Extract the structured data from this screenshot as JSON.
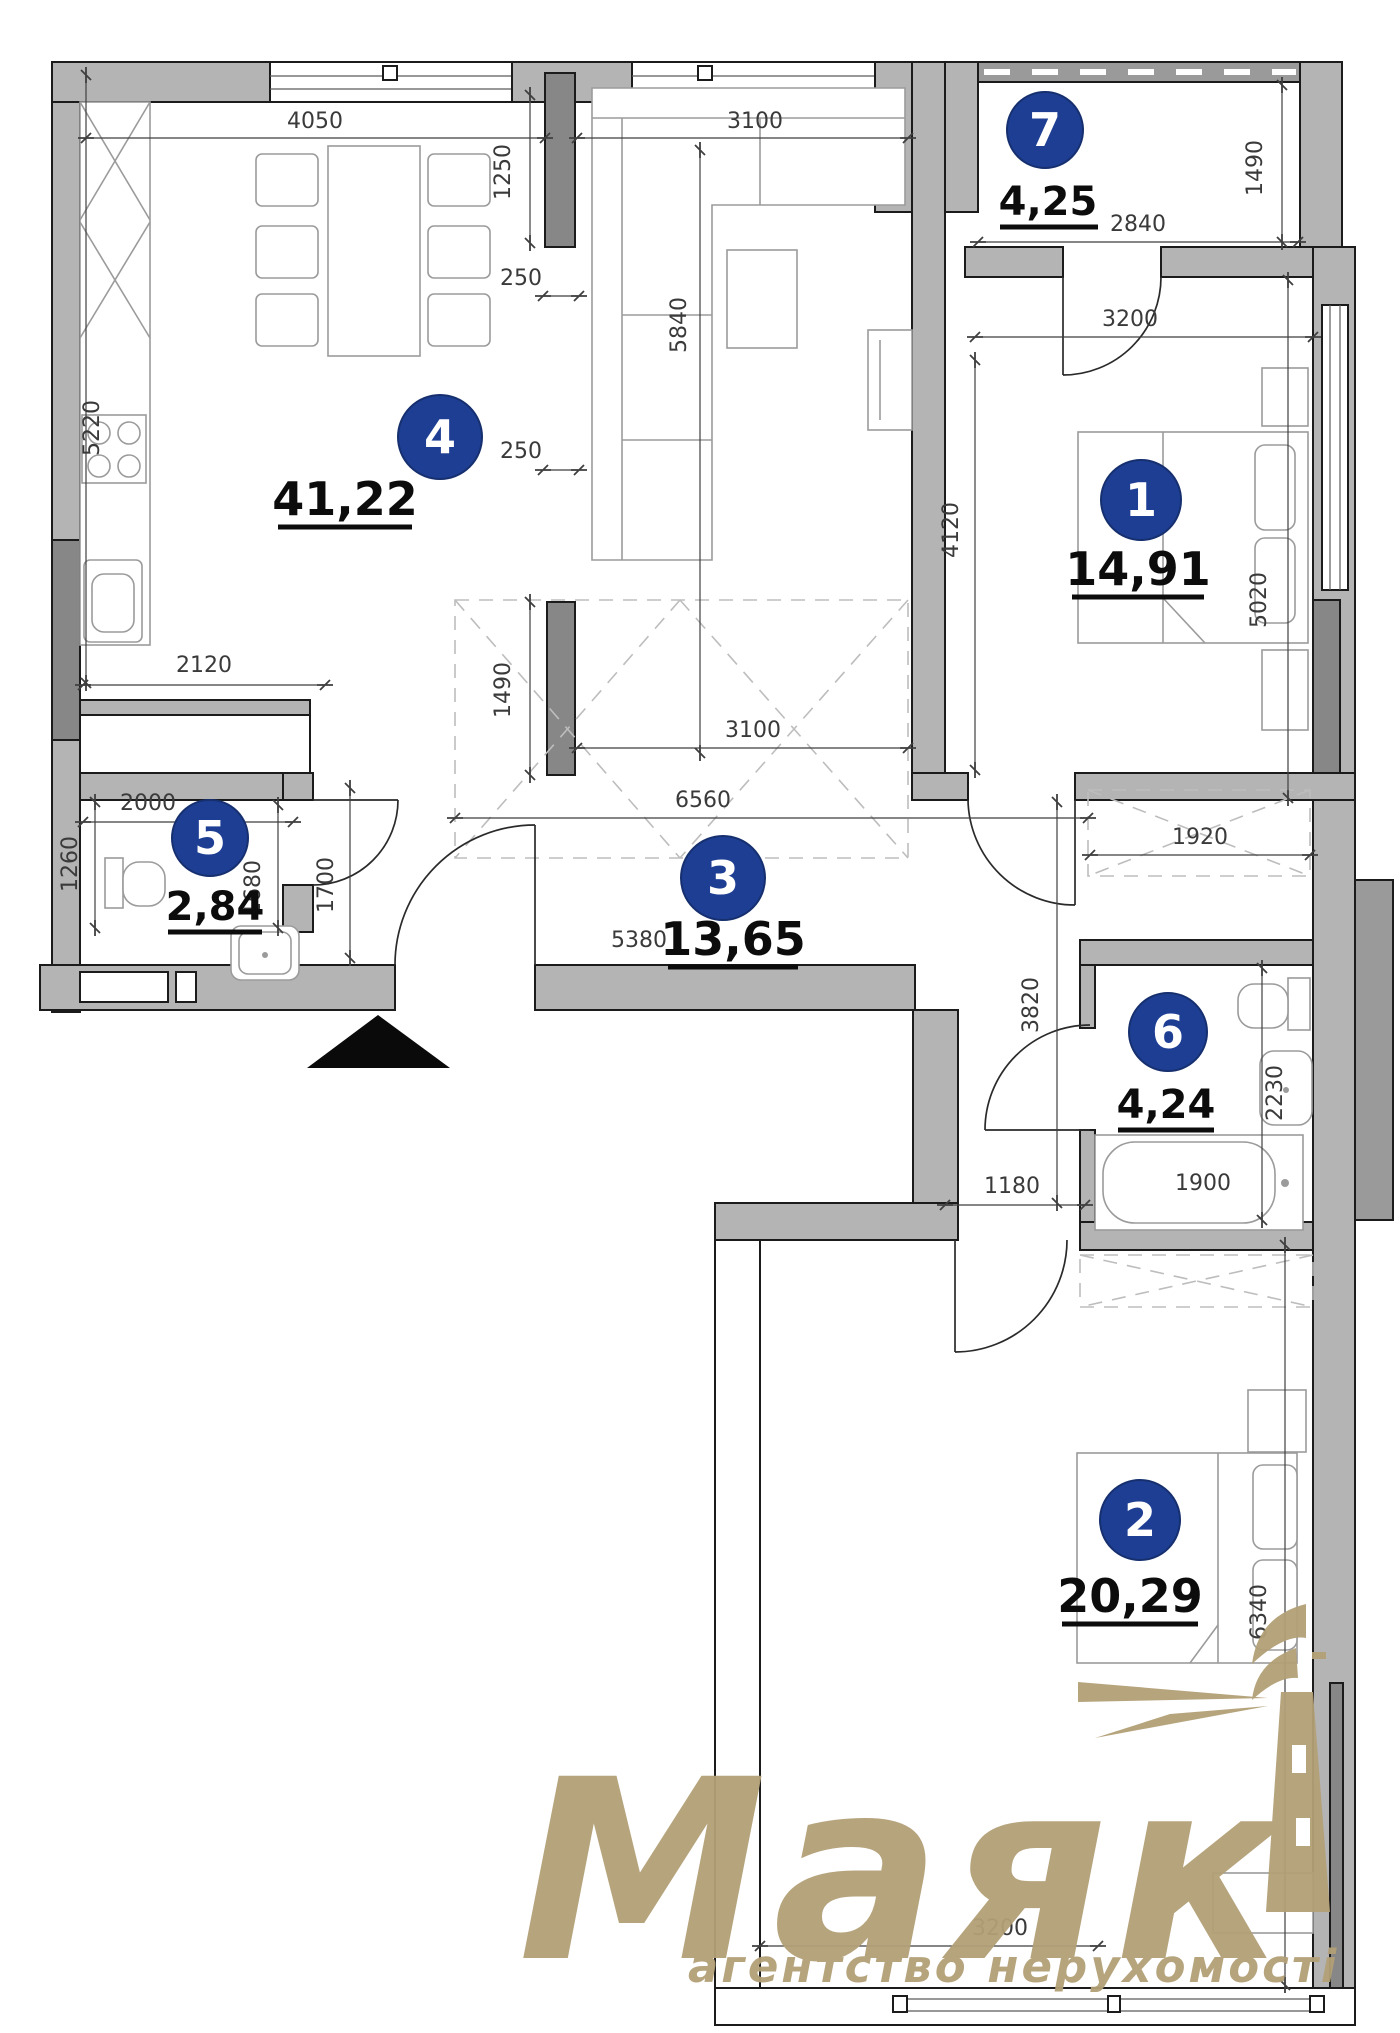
{
  "brand": {
    "name": "Маяк",
    "tagline": "агентство нерухомості",
    "color": "#b3a077"
  },
  "badge_color": "#1e3e93",
  "rooms": [
    {
      "number": "1",
      "area": "14,91"
    },
    {
      "number": "2",
      "area": "20,29"
    },
    {
      "number": "3",
      "area": "13,65"
    },
    {
      "number": "4",
      "area": "41,22"
    },
    {
      "number": "5",
      "area": "2,84"
    },
    {
      "number": "6",
      "area": "4,24"
    },
    {
      "number": "7",
      "area": "4,25"
    }
  ],
  "dims": {
    "d5220": "5220",
    "d4050": "4050",
    "d3100_top": "3100",
    "d1250": "1250",
    "d250_top": "250",
    "d250_low": "250",
    "d1490_pier": "1490",
    "d5840": "5840",
    "d2840": "2840",
    "d1490_balc": "1490",
    "d3200_bed1": "3200",
    "d4120": "4120",
    "d5020": "5020",
    "d2120": "2120",
    "d2000": "2000",
    "d1260": "1260",
    "d1680": "1680",
    "d1700": "1700",
    "d5380": "5380",
    "d6560": "6560",
    "d3100_hall": "3100",
    "d1920": "1920",
    "d3820": "3820",
    "d1180": "1180",
    "d2230": "2230",
    "d1900": "1900",
    "d6340": "6340",
    "d3200_bed2": "3200"
  }
}
